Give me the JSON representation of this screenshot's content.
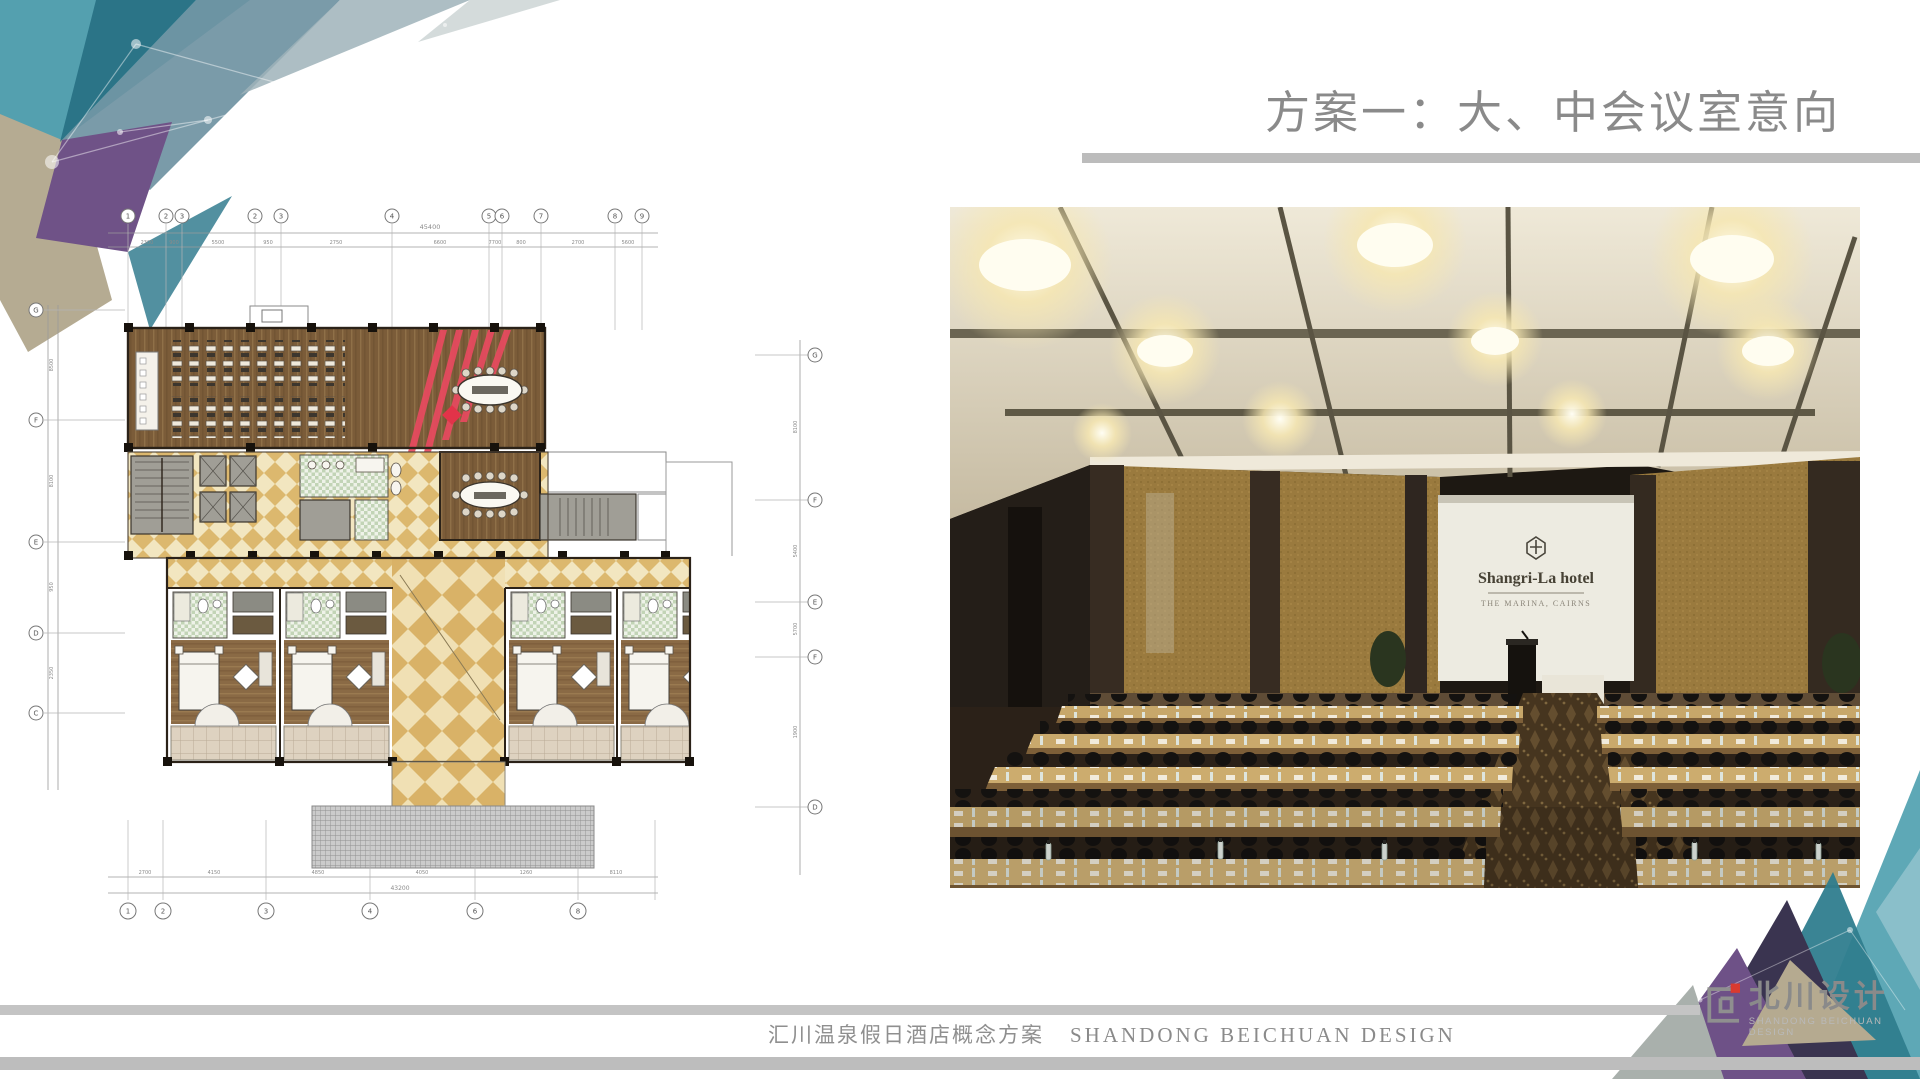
{
  "slide": {
    "title": "方案一：大、中会议室意向",
    "footer": {
      "cn": "汇川温泉假日酒店概念方案",
      "en": "SHANDONG BEICHUAN DESIGN"
    },
    "logo": {
      "cn": "北川设计",
      "en": "SHANDONG BEICHUAN DESIGN"
    },
    "photo": {
      "brand": "Shangri-La hotel",
      "brand_sub": "THE MARINA, CAIRNS"
    },
    "plan": {
      "dim_overall_top": "45400",
      "dim_overall_bottom": "43200",
      "grid_top": [
        "1",
        "2",
        "3",
        "2",
        "3",
        "4",
        "5",
        "6",
        "7",
        "8",
        "9"
      ],
      "grid_bottom": [
        "1",
        "2",
        "3",
        "4",
        "6",
        "8"
      ],
      "grid_left": [
        "G",
        "F",
        "E",
        "D",
        "C"
      ],
      "grid_right": [
        "G",
        "F",
        "E",
        "F",
        "D"
      ],
      "dims_top": [
        "2300",
        "900",
        "5500",
        "950",
        "2750",
        "6600",
        "7700",
        "800",
        "2700",
        "5600"
      ],
      "dims_bottom": [
        "2700",
        "4150",
        "4850",
        "4050",
        "1260",
        "8110"
      ],
      "dims_left": [
        "8500",
        "8100",
        "950",
        "2350"
      ],
      "dims_right": [
        "8100",
        "5400",
        "5700",
        "1900"
      ]
    },
    "colors": {
      "teal": "#4b99a9",
      "dark_teal": "#2c7285",
      "purple": "#6f5287",
      "beige": "#b3a88e",
      "bar_gray": "#bdbdbd",
      "title_gray": "#8a8a8a",
      "red": "#e8495f"
    }
  }
}
